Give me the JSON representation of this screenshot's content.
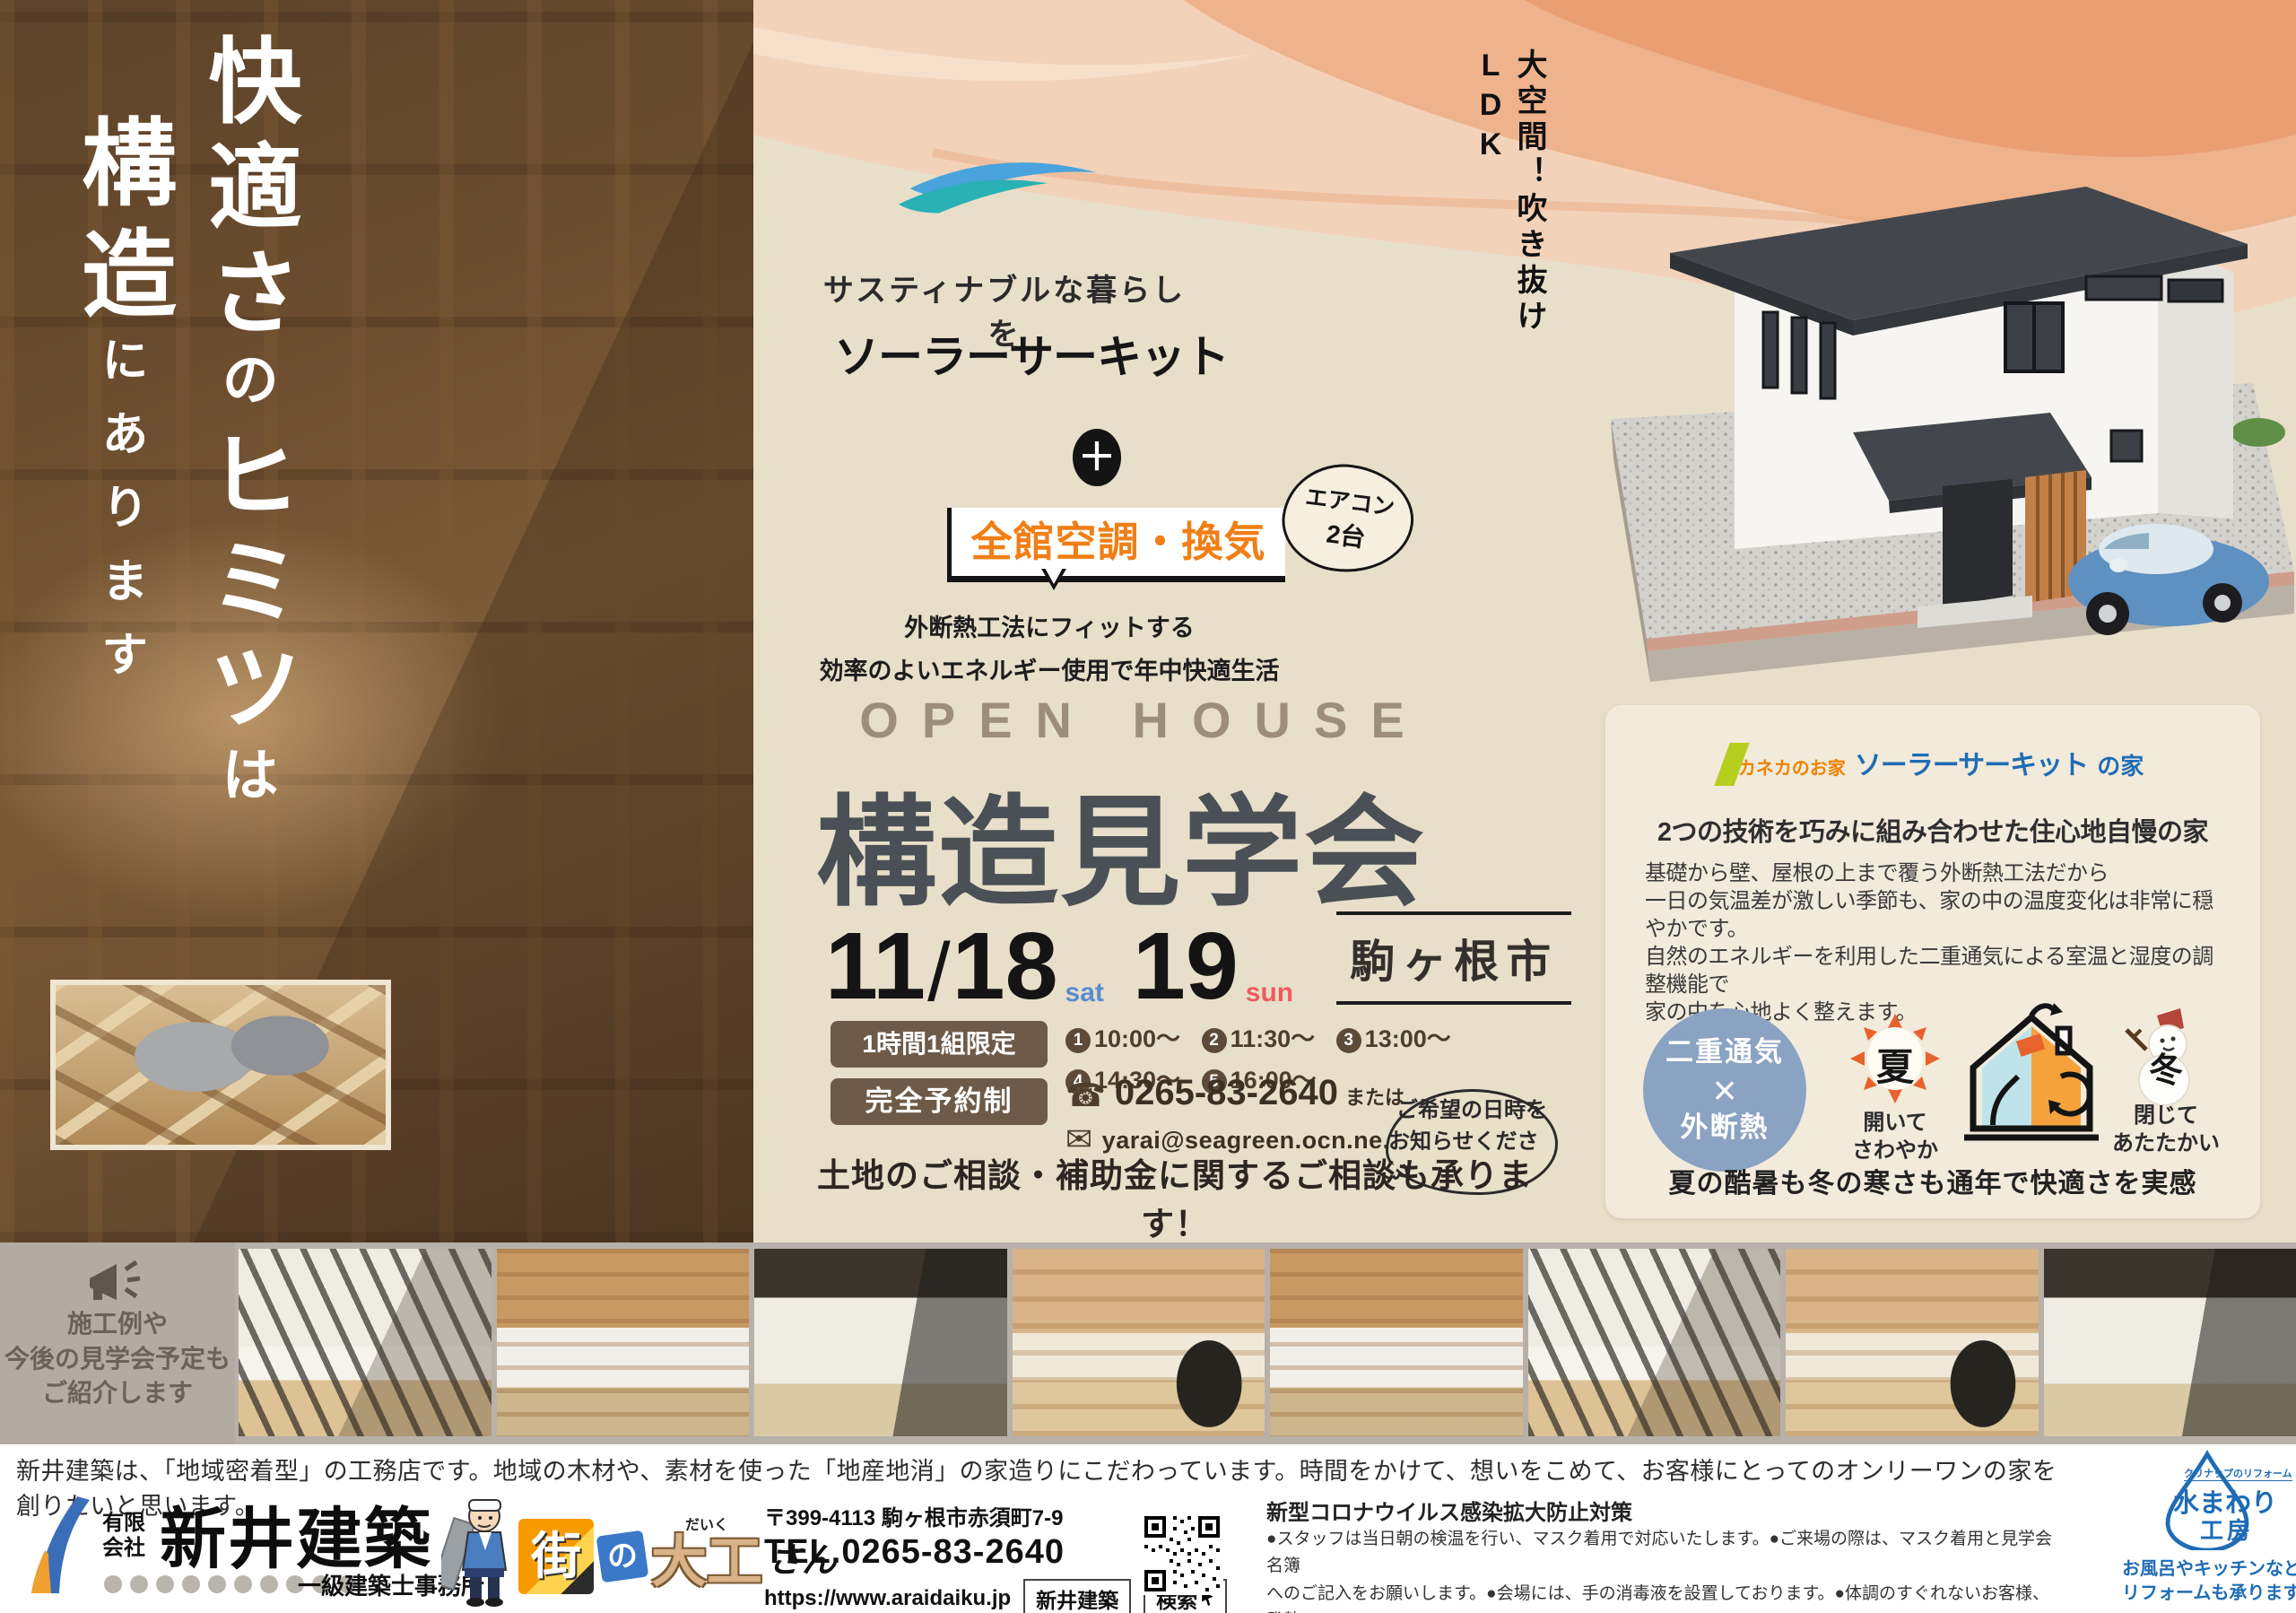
{
  "colors": {
    "peach": "#eeb38c",
    "paper": "#e8dfca",
    "card": "#f2ebdb",
    "brown": "#6e5a48",
    "accent_orange": "#f07f16",
    "brand_blue": "#1f6cb5",
    "kaneka_orange": "#ef8200",
    "kaneka_green": "#b6ce1e",
    "date_sat": "#5b8bd0",
    "date_sun": "#ef5a5f",
    "title_gray": "#4a5056"
  },
  "left": {
    "main": [
      {
        "t": "快適さ"
      },
      {
        "t": "の"
      },
      {
        "t": "ヒミツ"
      },
      {
        "t": "は"
      }
    ],
    "sub": [
      {
        "t": "構造"
      },
      {
        "t": "にあります"
      }
    ]
  },
  "center": {
    "tagline": "サスティナブルな暮らしを",
    "product": "ソーラーサーキット",
    "plus": "＋",
    "ac": "全館空調・換気",
    "ac_note1": "エアコン",
    "ac_note2": "2台",
    "sub1": "外断熱工法にフィットする",
    "sub2": "効率のよいエネルギー使用で年中快適生活",
    "open_house": "OPEN HOUSE",
    "title": "構造見学会",
    "month": "11",
    "slash": "/",
    "day1": "18",
    "dow1": "sat",
    "day2": "19",
    "dow2": "sun",
    "location": "駒ヶ根市",
    "limited": "1時間1組限定",
    "times": [
      {
        "n": "1",
        "t": "10:00〜"
      },
      {
        "n": "2",
        "t": "11:30〜"
      },
      {
        "n": "3",
        "t": "13:00〜"
      },
      {
        "n": "4",
        "t": "14:30〜"
      },
      {
        "n": "5",
        "t": "16:00〜"
      }
    ],
    "reserved": "完全予約制",
    "phone_icon": "☎",
    "phone": "0265-83-2640",
    "or": "または",
    "mail_icon": "✉",
    "email": "yarai@seagreen.ocn.ne.jp",
    "wish1": "ご希望の日時を",
    "wish2": "お知らせください",
    "consult": "土地のご相談・補助金に関するご相談も承ります！"
  },
  "right": {
    "vert1": "大空間！",
    "vert2": "吹き抜けLDK",
    "card": {
      "brand_small": "カネカのお家",
      "brand_main": "ソーラーサーキット",
      "brand_suffix": "の家",
      "heading": "2つの技術を巧みに組み合わせた住心地自慢の家",
      "body": [
        "基礎から壁、屋根の上まで覆う外断熱工法だから",
        "一日の気温差が激しい季節も、家の中の温度変化は非常に穏やかです。",
        "自然のエネルギーを利用した二重通気による室温と湿度の調整機能で",
        "家の中を心地よく整えます。"
      ],
      "circle1": "二重通気",
      "circle_x": "×",
      "circle2": "外断熱",
      "summer_kanji": "夏",
      "summer1": "開いて",
      "summer2": "さわやか",
      "winter_kanji": "冬",
      "winter1": "閉じて",
      "winter2": "あたたかい",
      "caption": "夏の酷暑も冬の寒さも通年で快適さを実感"
    }
  },
  "strip": {
    "announce": [
      "施工例や",
      "今後の見学会予定も",
      "ご紹介します"
    ]
  },
  "footer": {
    "desc": "新井建築は、「地域密着型」の工務店です。地域の木材や、素材を使った「地産地消」の家造りにこだわっています。時間をかけて、想いをこめて、お客様にとってのオンリーワンの家を創りたいと思います。",
    "prefix1": "有限",
    "prefix2": "会社",
    "company": "新井建築",
    "license": "一級建築士事務所",
    "machi_a": "街",
    "machi_b": "の",
    "machi_c": "大工",
    "machi_furi": "だいく",
    "machi_d": "さん",
    "zip": "〒399-4113 駒ヶ根市赤須町7-9",
    "tel": "TEL.0265-83-2640",
    "url": "https://www.araidaiku.jp",
    "search_word": "新井建築",
    "search_btn": "検索",
    "covid_heading": "新型コロナウイルス感染拡大防止対策",
    "covid_lines": [
      "●スタッフは当日朝の検温を行い、マスク着用で対応いたします。●ご来場の際は、マスク着用と見学会名簿",
      "へのご記入をお願いします。●会場には、手の消毒液を設置しております。●体調のすぐれないお客様、発熱",
      "のあるお客様は、遠慮なくご予約をキャンセルなさってください。"
    ],
    "mizu_brand": "クリナップのリフォーム",
    "mizu_main": "水まわり",
    "mizu_sub": "工房",
    "mizu_cap1": "お風呂やキッチンなどの",
    "mizu_cap2": "リフォームも承ります"
  }
}
